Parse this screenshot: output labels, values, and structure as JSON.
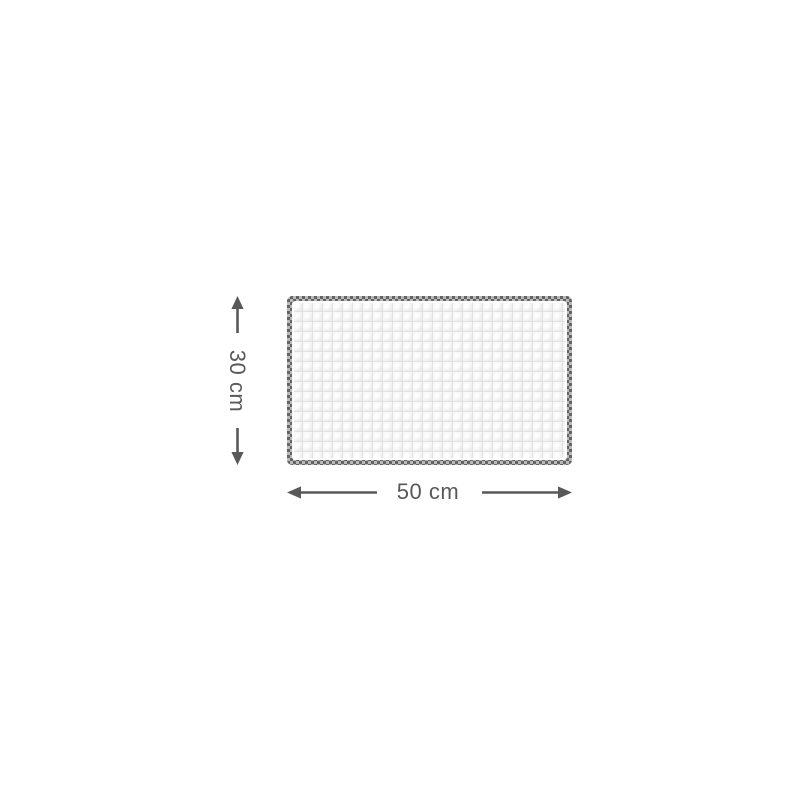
{
  "diagram": {
    "kind": "product-dimension-diagram",
    "height_dimension": {
      "label": "30 cm"
    },
    "width_dimension": {
      "label": "50 cm"
    },
    "colors": {
      "background": "#ffffff",
      "dimension_lines_and_text": "#58595b",
      "stitch_border_dark": "#646464",
      "stitch_border_light": "#b9b9b9",
      "fabric_base": "#f7f7f7",
      "fabric_grid_line": "#d7d7d7"
    },
    "icons": [
      "arrow-up-icon",
      "arrow-down-icon",
      "arrow-left-icon",
      "arrow-right-icon"
    ]
  }
}
